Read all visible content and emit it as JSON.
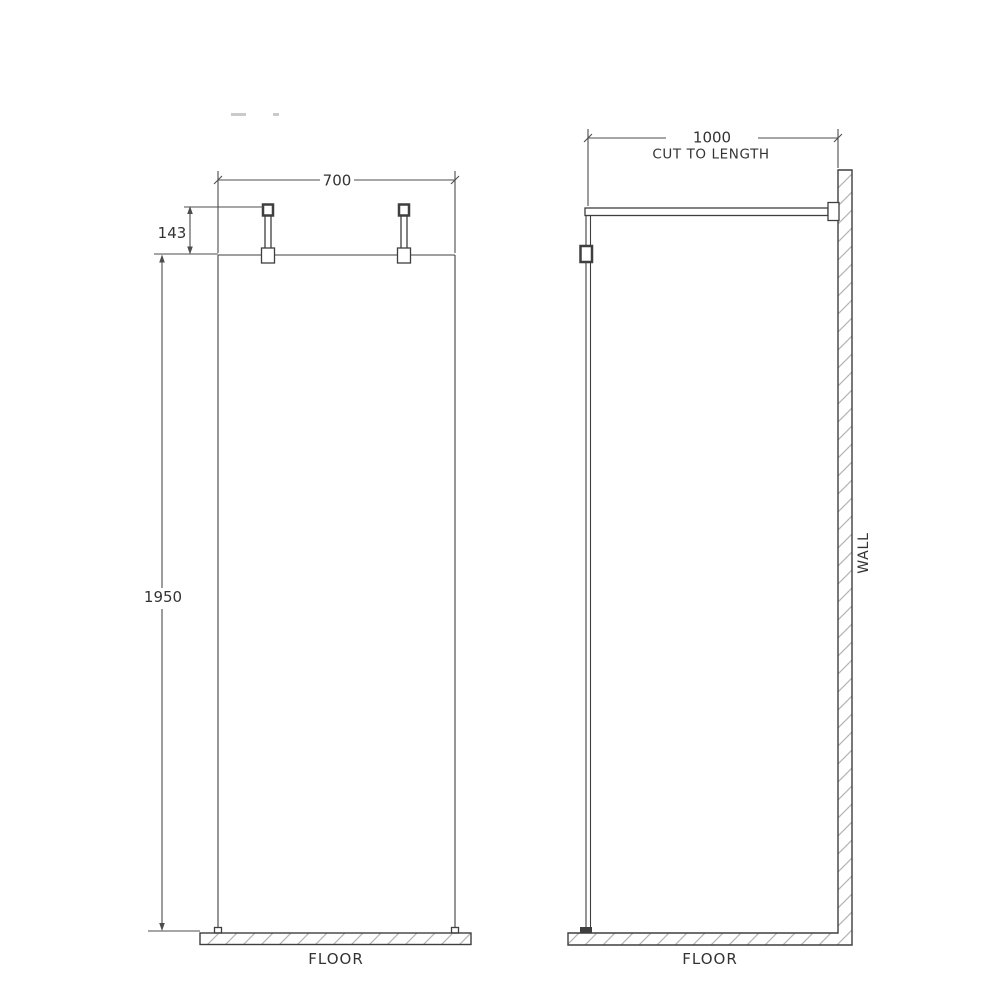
{
  "diagram": {
    "front_view": {
      "width_dim": "700",
      "fixing_dim": "143",
      "height_dim": "1950",
      "floor_label": "FLOOR"
    },
    "side_view": {
      "depth_dim": "1000",
      "depth_note": "CUT TO LENGTH",
      "wall_label": "WALL",
      "floor_label": "FLOOR"
    },
    "colors": {
      "line": "#3f3f3f",
      "dim_line": "#4d4d4d",
      "text": "#333333",
      "hatch": "#b4b4b4",
      "background": "#ffffff"
    }
  }
}
